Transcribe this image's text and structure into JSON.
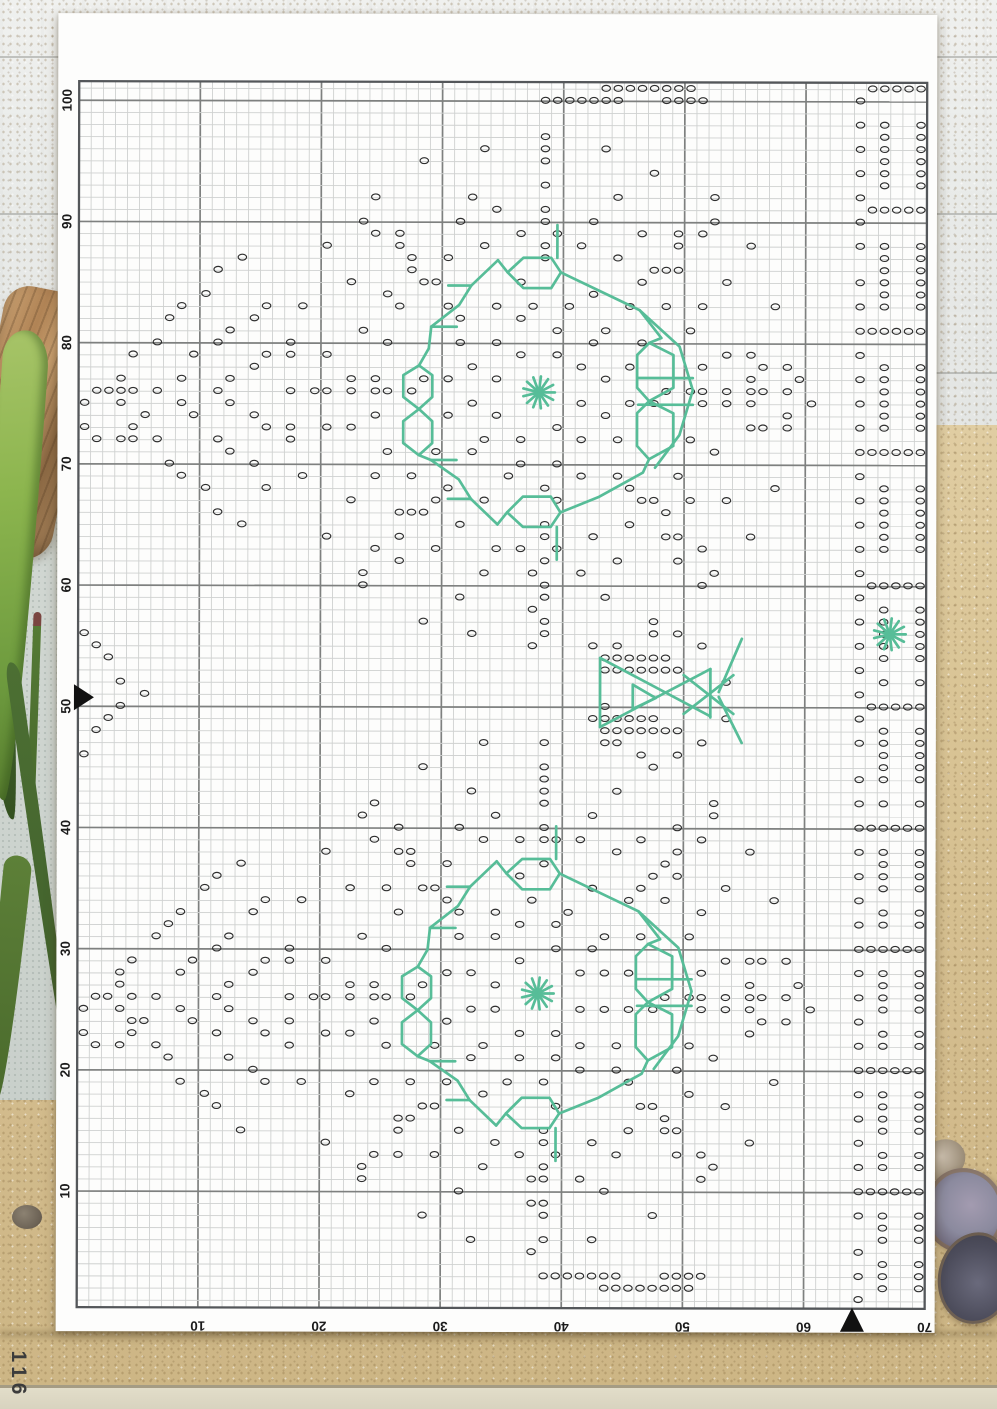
{
  "page": {
    "number": "116"
  },
  "chart_data": {
    "type": "cross_stitch_chart",
    "grid": {
      "cols": 70,
      "rows": 101,
      "cell_w": 12.114,
      "cell_h": 12.12,
      "left": 21,
      "top": 68,
      "first_line_offset": 7,
      "bold_every": 10
    },
    "axes": {
      "left": {
        "labels": [
          "100",
          "90",
          "80",
          "70",
          "60",
          "50",
          "40",
          "30",
          "20",
          "10"
        ]
      },
      "bottom": {
        "labels": [
          "10",
          "20",
          "30",
          "40",
          "50",
          "60",
          "70"
        ]
      }
    },
    "markers": {
      "left_label": "50",
      "left_line_index": 51,
      "bottom_col": 64
    },
    "symbols": {
      "stitch_symbol": "o",
      "star_symbol": "asterisk-burst"
    },
    "colors": {
      "stitch": "#2e2e2e",
      "backstitch": "#57bd98",
      "grid_thin": "#cfd1d0",
      "grid_bold": "#7e807f",
      "grid_border": "#54575a",
      "label": "#1b1b1b",
      "marker": "#111111",
      "paper": "#fdfdfc"
    },
    "stars": [
      [
        38,
        25.6
      ],
      [
        67,
        45.5
      ],
      [
        38,
        75.2
      ]
    ],
    "motif_centers": [
      [
        38,
        25.6
      ],
      [
        38,
        75.2
      ]
    ],
    "motif_rings": [
      [
        3.6,
        8,
        0.42
      ],
      [
        5.8,
        12,
        0.05
      ],
      [
        7.6,
        14,
        0.24
      ],
      [
        9.5,
        10,
        0.32
      ],
      [
        13.2,
        28,
        0.12
      ],
      [
        15.4,
        24,
        0.01
      ],
      [
        17.6,
        18,
        0.14
      ],
      [
        21,
        26,
        0.02
      ]
    ],
    "motif_sub_rings": [
      {
        "c": [
          -35,
          2
        ],
        "r": 2.4,
        "n": 9,
        "ph": 0.1
      },
      {
        "c": [
          19.6,
          0
        ],
        "r": 2.6,
        "n": 8,
        "ph": 0.05
      }
    ],
    "motif_dot_lines": [
      [
        [
          10.8,
          0
        ],
        [
          20.3,
          0
        ],
        7
      ],
      [
        [
          -10.8,
          0
        ],
        [
          -20.3,
          0
        ],
        7
      ],
      [
        [
          0,
          -10.8
        ],
        [
          0,
          -20.3
        ],
        7
      ],
      [
        [
          0,
          10.8
        ],
        [
          0,
          20.3
        ],
        7
      ],
      [
        [
          7.6,
          -7.6
        ],
        [
          14.4,
          -14.4
        ],
        6
      ],
      [
        [
          -7.6,
          -7.6
        ],
        [
          -14.4,
          -14.4
        ],
        6
      ],
      [
        [
          7.6,
          7.6
        ],
        [
          14.4,
          14.4
        ],
        6
      ],
      [
        [
          -7.6,
          7.6
        ],
        [
          -14.4,
          14.4
        ],
        6
      ],
      [
        [
          -25,
          -11.2
        ],
        [
          -36,
          -0.2
        ],
        9
      ],
      [
        [
          -36,
          -0.2
        ],
        [
          -25,
          11
        ],
        9
      ],
      [
        [
          -22.5,
          -7.6
        ],
        [
          -31.5,
          -0.2
        ],
        7
      ],
      [
        [
          -31.5,
          -0.2
        ],
        [
          -22.5,
          7.4
        ],
        7
      ],
      [
        [
          -20.5,
          -4.2
        ],
        [
          -26.6,
          -0.2
        ],
        5
      ],
      [
        [
          -26.6,
          -0.2
        ],
        [
          -20.5,
          4
        ],
        5
      ]
    ],
    "abs_rings": [
      {
        "c": [
          48.2,
          50.5
        ],
        "r": 5.2,
        "n": 12,
        "ph": 0.13
      }
    ],
    "abs_dot_lines": [
      [
        [
          43,
          0.95
        ],
        [
          50.5,
          0.95
        ],
        8
      ],
      [
        [
          38,
          1.95
        ],
        [
          44.5,
          1.95
        ],
        7
      ],
      [
        [
          48.5,
          1.95
        ],
        [
          51.5,
          1.95
        ],
        4
      ],
      [
        [
          43,
          99.8
        ],
        [
          50.5,
          99.8
        ],
        8
      ],
      [
        [
          38,
          98.8
        ],
        [
          44.5,
          98.8
        ],
        7
      ],
      [
        [
          48.5,
          98.8
        ],
        [
          51.5,
          98.8
        ],
        4
      ],
      [
        [
          0.6,
          45.6
        ],
        [
          5,
          50.3
        ],
        5
      ],
      [
        [
          5,
          50.3
        ],
        [
          0.6,
          55
        ],
        5
      ],
      [
        [
          64.35,
          1.7
        ],
        [
          64.35,
          100.1
        ],
        49
      ],
      {
        "a": [
          65.3,
          0.8
        ],
        "b": [
          69.9,
          0.8
        ],
        "n": 5,
        "rep": 10,
        "dy": 10.06
      },
      {
        "a": [
          66.7,
          3
        ],
        "b": [
          66.7,
          8.8
        ],
        "n": 6,
        "rep": 10,
        "dy": 10.06
      },
      {
        "a": [
          69.7,
          3
        ],
        "b": [
          69.7,
          8.8
        ],
        "n": 6,
        "rep": 10,
        "dy": 10.06
      },
      [
        [
          43.5,
          47.3
        ],
        [
          48.5,
          47.3
        ],
        6
      ],
      [
        [
          44.5,
          48.3
        ],
        [
          49.5,
          48.3
        ],
        6
      ],
      [
        [
          42.5,
          52.8
        ],
        [
          47.5,
          52.8
        ],
        6
      ],
      [
        [
          43.5,
          53.8
        ],
        [
          49.5,
          53.8
        ],
        7
      ]
    ],
    "motif_back": [
      {
        "p": [
          [
            -3.4,
            -10.9
          ],
          [
            -5.6,
            -8.8
          ],
          [
            -6.6,
            -7.2
          ],
          [
            -8.9,
            -5.4
          ],
          [
            -9.1,
            -3.6
          ],
          [
            -9.9,
            -2.2
          ]
        ]
      },
      {
        "p": [
          [
            -5.6,
            -8.8
          ],
          [
            -7.5,
            -8.8
          ]
        ]
      },
      {
        "p": [
          [
            -8.9,
            -5.4
          ],
          [
            -6.8,
            -5.4
          ]
        ]
      },
      {
        "p": [
          [
            -9.9,
            -2.2
          ],
          [
            -11.2,
            -1.4
          ],
          [
            -11.2,
            0.4
          ],
          [
            -9.9,
            1.4
          ],
          [
            -8.8,
            0.4
          ],
          [
            -8.8,
            -1.4
          ]
        ],
        "closed": true
      },
      {
        "p": [
          [
            -9.9,
            1.4
          ],
          [
            -11.2,
            2.4
          ],
          [
            -11.2,
            4.2
          ],
          [
            -9.9,
            5.2
          ],
          [
            -8.8,
            4.2
          ],
          [
            -8.8,
            2.4
          ]
        ],
        "closed": true
      },
      {
        "p": [
          [
            -9.9,
            5.2
          ],
          [
            -8.9,
            5.6
          ],
          [
            -6.6,
            7.2
          ],
          [
            -5.6,
            8.8
          ],
          [
            -3.4,
            10.9
          ]
        ]
      },
      {
        "p": [
          [
            -8.9,
            5.6
          ],
          [
            -6.8,
            5.6
          ]
        ]
      },
      {
        "p": [
          [
            -5.6,
            8.8
          ],
          [
            -7.5,
            8.8
          ]
        ]
      },
      {
        "p": [
          [
            -2.6,
            -9.9
          ],
          [
            -1.3,
            -11.1
          ],
          [
            1,
            -11.1
          ],
          [
            1.8,
            -9.9
          ],
          [
            1,
            -8.6
          ],
          [
            -1.3,
            -8.6
          ]
        ],
        "closed": true
      },
      {
        "p": [
          [
            -2.6,
            9.9
          ],
          [
            -1.3,
            11.1
          ],
          [
            1,
            11.1
          ],
          [
            1.8,
            9.9
          ],
          [
            1,
            8.6
          ],
          [
            -1.3,
            8.6
          ]
        ],
        "closed": true
      },
      {
        "p": [
          [
            -2.6,
            -9.9
          ],
          [
            -3.4,
            -10.9
          ]
        ]
      },
      {
        "p": [
          [
            -2.6,
            9.9
          ],
          [
            -3.4,
            10.9
          ]
        ]
      },
      {
        "p": [
          [
            1.8,
            -9.9
          ],
          [
            6,
            -7.9
          ],
          [
            8.3,
            -6.8
          ],
          [
            10.1,
            -4.5
          ],
          [
            9.1,
            -4.1
          ]
        ]
      },
      {
        "p": [
          [
            9.1,
            -4.1
          ],
          [
            11.1,
            -3.1
          ],
          [
            11.1,
            -0.4
          ],
          [
            9.1,
            0.7
          ],
          [
            8.1,
            -0.4
          ],
          [
            8.1,
            -3.1
          ]
        ],
        "closed": true
      },
      {
        "p": [
          [
            9.1,
            0.7
          ],
          [
            11.1,
            1.7
          ],
          [
            11.1,
            4.4
          ],
          [
            9.1,
            5.5
          ],
          [
            8.1,
            4.4
          ],
          [
            8.1,
            1.7
          ]
        ],
        "closed": true
      },
      {
        "p": [
          [
            8.3,
            -6.8
          ],
          [
            11.6,
            -3.8
          ],
          [
            12.7,
            -0.2
          ],
          [
            11.6,
            3.5
          ],
          [
            9.6,
            6.2
          ]
        ]
      },
      {
        "p": [
          [
            9.1,
            5.5
          ],
          [
            8.6,
            6.6
          ],
          [
            5,
            8.6
          ],
          [
            1.8,
            9.9
          ]
        ]
      },
      {
        "p": [
          [
            1.5,
            -11.1
          ],
          [
            1.5,
            -13.8
          ]
        ]
      },
      {
        "p": [
          [
            1.5,
            11.1
          ],
          [
            1.5,
            13.8
          ]
        ]
      },
      {
        "p": [
          [
            8.2,
            -1.2
          ],
          [
            12.7,
            -1.2
          ]
        ]
      },
      {
        "p": [
          [
            8.2,
            1
          ],
          [
            12.7,
            1
          ]
        ]
      }
    ],
    "bow_back": [
      {
        "p": [
          [
            43.1,
            47.5
          ],
          [
            43.1,
            53.2
          ]
        ]
      },
      {
        "p": [
          [
            43.1,
            47.5
          ],
          [
            52.2,
            52.3
          ]
        ]
      },
      {
        "p": [
          [
            43.1,
            53.2
          ],
          [
            52.2,
            48.4
          ]
        ]
      },
      {
        "p": [
          [
            45.8,
            49.7
          ],
          [
            47.7,
            50.8
          ],
          [
            45.8,
            51.7
          ]
        ],
        "closed": true
      },
      {
        "p": [
          [
            52.2,
            48.4
          ],
          [
            52.2,
            52.4
          ]
        ]
      },
      {
        "p": [
          [
            50,
            48.9
          ],
          [
            54.1,
            52.1
          ]
        ]
      },
      {
        "p": [
          [
            50,
            52.1
          ],
          [
            54.1,
            48.9
          ]
        ]
      },
      {
        "p": [
          [
            52.9,
            50.3
          ],
          [
            54.8,
            45.9
          ]
        ]
      },
      {
        "p": [
          [
            52.9,
            50.7
          ],
          [
            54.8,
            54.5
          ]
        ]
      }
    ]
  },
  "background": {
    "wood": "#eceeec",
    "seam": "#929490",
    "sand": "#d9c495",
    "stone": "#ccd3ce",
    "board": "#e2ddc9",
    "driftwood": "#b08355",
    "leaf_bright": "#8cb54e",
    "leaf_dark": "#3d5c2b",
    "leaf_mid": "#4c6f33",
    "shell_light": "#8b8a9e",
    "shell_dark": "#4d4d5c",
    "pebble": "#6b6154",
    "page_number_color": "#3c3c3c"
  }
}
